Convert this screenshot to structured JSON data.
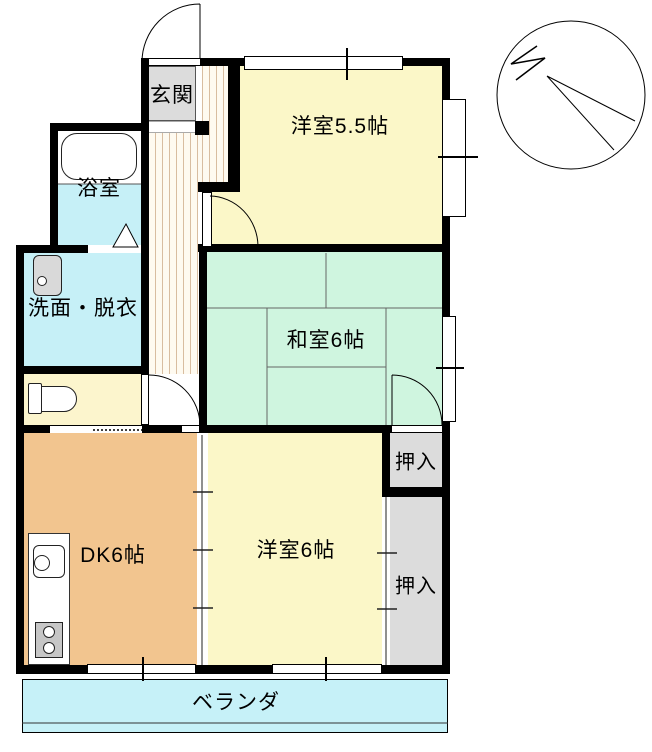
{
  "plan_title": "2DK floor plan",
  "rooms": {
    "genkan": {
      "label": "玄関",
      "color": "#dcdcdc"
    },
    "bathroom": {
      "label": "浴室",
      "color": "#c6f0f7"
    },
    "washroom": {
      "label": "洗面・脱衣",
      "color": "#c6f0f7"
    },
    "toilet": {
      "color": "#fcf5cd"
    },
    "western55": {
      "label": "洋室5.5帖",
      "color": "#fbf7c8"
    },
    "japanese6": {
      "label": "和室6帖",
      "color": "#cff5df"
    },
    "dk": {
      "label": "DK6帖",
      "color": "#f2c58f"
    },
    "western6": {
      "label": "洋室6帖",
      "color": "#fbf7c8"
    },
    "closet1": {
      "label": "押入",
      "color": "#dcdcdc"
    },
    "closet2": {
      "label": "押入",
      "color": "#dcdcdc"
    },
    "veranda": {
      "label": "ベランダ",
      "color": "#c6f1f8"
    },
    "hall": {
      "stripe_color": "#d8bda0"
    }
  },
  "compass": {
    "label": "N"
  },
  "colors": {
    "wall": "#000000",
    "toilet_room": "#fcf5cd",
    "fixture_gray": "#d9d9d9",
    "stove_gray": "#c6c6c6"
  }
}
